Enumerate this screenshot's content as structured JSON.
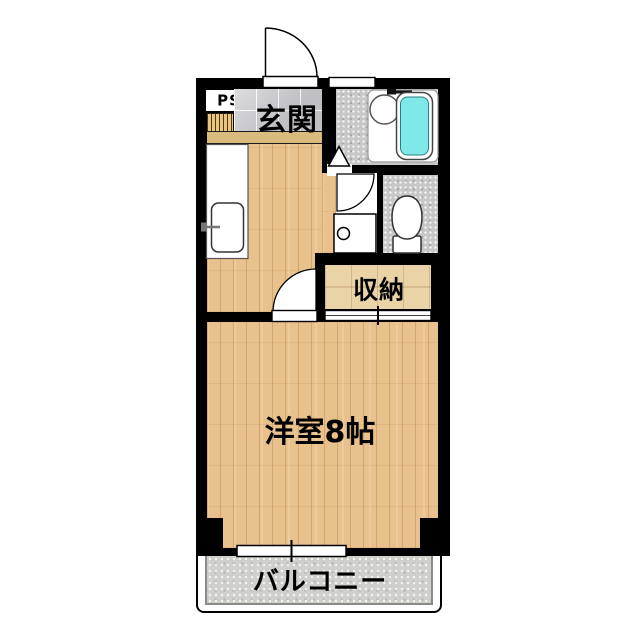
{
  "labels": {
    "pipe_space": "PS",
    "entrance": "玄関",
    "storage": "収納",
    "main_room": "洋室8帖",
    "balcony": "バルコニー"
  },
  "rooms": [
    {
      "name": "entrance-genkan",
      "label": "玄関",
      "floor": "gray-tile"
    },
    {
      "name": "kitchen-hall",
      "label": "",
      "floor": "wood"
    },
    {
      "name": "bathroom",
      "label": "",
      "floor": "gray-speckle"
    },
    {
      "name": "toilet-room",
      "label": "",
      "floor": "gray-speckle"
    },
    {
      "name": "storage-closet",
      "label": "収納",
      "floor": "light-wood"
    },
    {
      "name": "western-room-8jo",
      "label": "洋室8帖",
      "floor": "wood"
    },
    {
      "name": "balcony",
      "label": "バルコニー",
      "floor": "concrete"
    }
  ],
  "fixtures": [
    "entrance-door-swing",
    "shoe-cabinet-slats",
    "entrance-step",
    "kitchen-counter",
    "kitchen-sink",
    "kitchen-faucet",
    "bath-unit",
    "bathtub",
    "bath-sink",
    "bath-faucet",
    "bathroom-folding-door-triangle",
    "washroom-door-swing",
    "washing-machine-pan",
    "toilet",
    "room-door-swing",
    "storage-sliding-door",
    "top-window",
    "balcony-window"
  ],
  "colors": {
    "wall": "#000000",
    "wood_floor": "#E9C18C",
    "tile_floor": "#CBCBD0",
    "wet_floor": "#C7C7C7",
    "storage_floor": "#EAD3A6",
    "balcony_floor": "#CFCFCC",
    "bathtub_water": "#7FE9E9",
    "slat_color": "#EAC77D",
    "step_color": "#D9BA7F",
    "fixture_line": "#333333"
  }
}
